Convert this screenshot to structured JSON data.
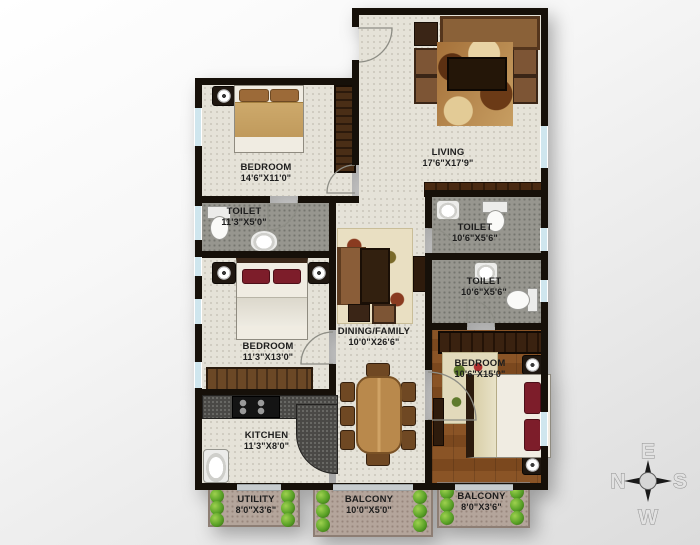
{
  "plan": {
    "rooms": {
      "bedroom1": {
        "name": "BEDROOM",
        "dims": "14'6\"X11'0\""
      },
      "living": {
        "name": "LIVING",
        "dims": "17'6\"X17'9\""
      },
      "toilet1": {
        "name": "TOILET",
        "dims": "11'3\"X5'0\""
      },
      "toilet2": {
        "name": "TOILET",
        "dims": "10'6\"X5'6\""
      },
      "toilet3": {
        "name": "TOILET",
        "dims": "10'6\"X5'6\""
      },
      "bedroom2": {
        "name": "BEDROOM",
        "dims": "11'3\"X13'0\""
      },
      "dining_family": {
        "name": "DINING/FAMILY",
        "dims": "10'0\"X26'6\""
      },
      "kitchen": {
        "name": "KITCHEN",
        "dims": "11'3\"X8'0\""
      },
      "bedroom3": {
        "name": "BEDROOM",
        "dims": "10'6\"X15'0\""
      },
      "utility": {
        "name": "UTILITY",
        "dims": "8'0\"X3'6\""
      },
      "balcony1": {
        "name": "BALCONY",
        "dims": "10'0\"X5'0\""
      },
      "balcony2": {
        "name": "BALCONY",
        "dims": "8'0\"X3'6\""
      }
    },
    "compass": {
      "top": "E",
      "left": "N",
      "right": "S",
      "bottom": "W"
    },
    "colors": {
      "wall": "#161009",
      "floor": "#e5e2d8",
      "toilet_floor": "#97968f",
      "wood_floor": "#8a5426",
      "balcony_floor": "#b4a59b",
      "window": "#cfe6ee",
      "plant": "#5aa227"
    }
  }
}
